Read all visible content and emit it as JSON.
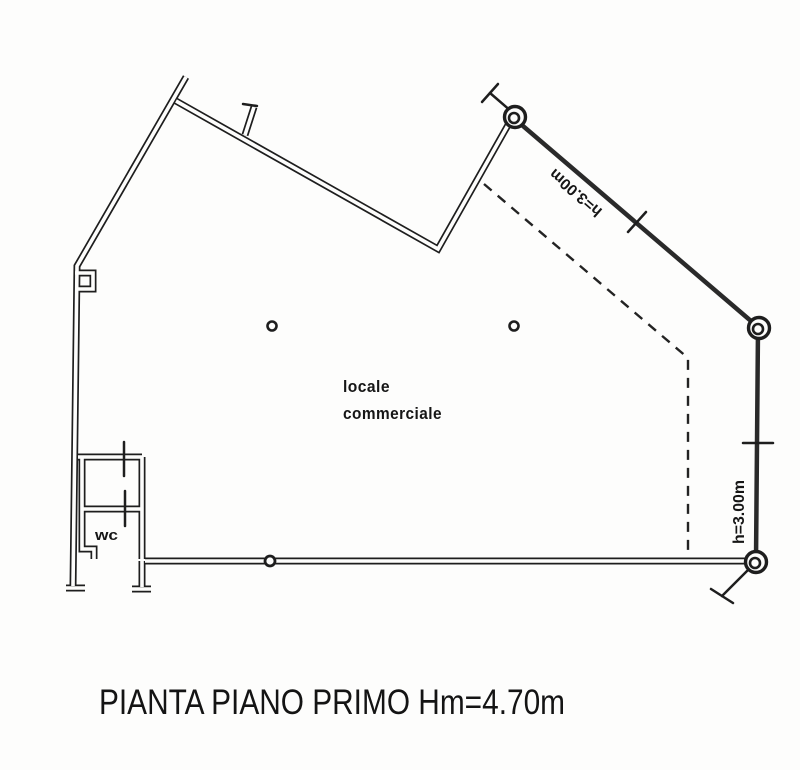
{
  "plan": {
    "title": "PIANTA PIANO PRIMO Hm=4.70m",
    "labels": {
      "main_room_line1": "locale",
      "main_room_line2": "commerciale",
      "wc": "wc"
    },
    "dimensions": {
      "upper_parapet_height": "h=3.00m",
      "right_parapet_height": "h=3.00m"
    }
  },
  "colors": {
    "ink": "#1e1e1e",
    "background": "#fdfdfc"
  }
}
